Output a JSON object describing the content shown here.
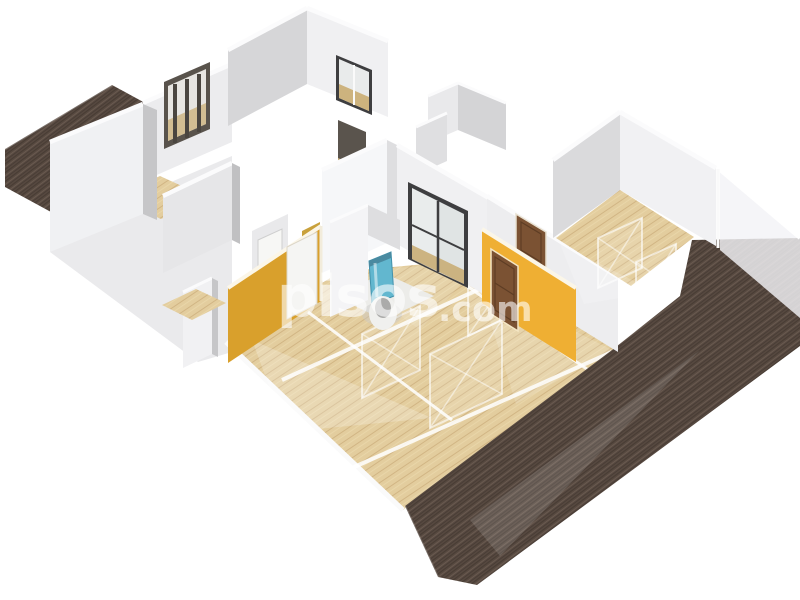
{
  "watermark": {
    "brand": "pisos",
    "suffix": ".com"
  },
  "palette": {
    "background": "#ffffff",
    "deck_wood": "#574940",
    "parquet": "#e3cd9e",
    "wall_white": "#f7f7f8",
    "wall_light": "#ededef",
    "wall_mid": "#dcdcde",
    "wall_shadow": "#c7c7c9",
    "accent_yellow_dark": "#d9a02c",
    "accent_yellow_bright": "#efaf33",
    "door_brown": "#7b5233",
    "window_frame": "#3e3e40",
    "toilet_blue": "#62b7cf",
    "watermark_white": "#ffffff"
  }
}
